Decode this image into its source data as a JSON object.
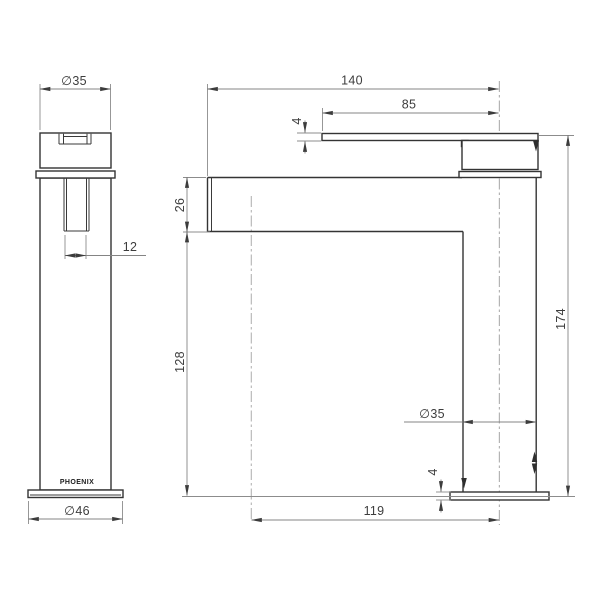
{
  "drawing": {
    "brand_label": "PHOENIX",
    "dims": {
      "handle_diameter": "∅35",
      "spout_end_width": "12",
      "base_diameter": "∅46",
      "spout_reach": "140",
      "lever_length": "85",
      "lever_thickness": "4",
      "spout_depth": "26",
      "under_spout_height": "128",
      "overall_height": "174",
      "body_diameter": "∅35",
      "base_thickness": "4",
      "outlet_offset": "119"
    }
  }
}
